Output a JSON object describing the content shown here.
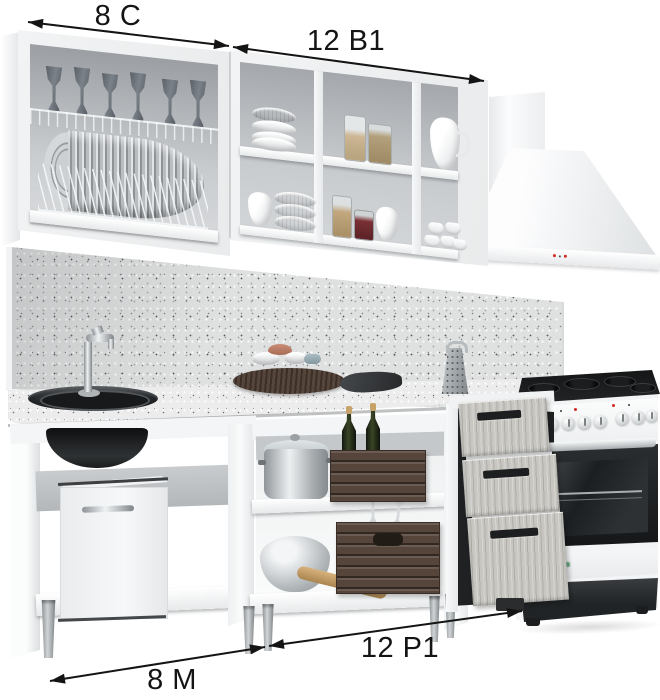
{
  "title": "Kitchen furniture set product render with module dimension annotations",
  "annotations": {
    "top_left_label": "8 С",
    "top_right_label": "12 В1",
    "bottom_right_label": "12 Р1",
    "bottom_left_label": "8 М"
  },
  "colors": {
    "background": "#ffffff",
    "annotation_text": "#141414",
    "cabinet_white": "#eff1f2",
    "interior_gray": "#b4b8bb",
    "speckled_surface": "#dfe0e0",
    "wood_drawer_front": "#c7c6c1",
    "crate_brown": "#55453b",
    "sink_black": "#1d2022",
    "indicator_red": "#cf2b24",
    "oven_logo_green": "#3c8f5a"
  },
  "components": [
    "wall-cabinet-dish-drainer",
    "wall-cabinet-open-shelves",
    "cooker-hood",
    "splashback",
    "countertop-with-sink",
    "sink-base-cabinet",
    "open-base-cabinet",
    "drawer-base-cabinet",
    "freestanding-cooker"
  ]
}
